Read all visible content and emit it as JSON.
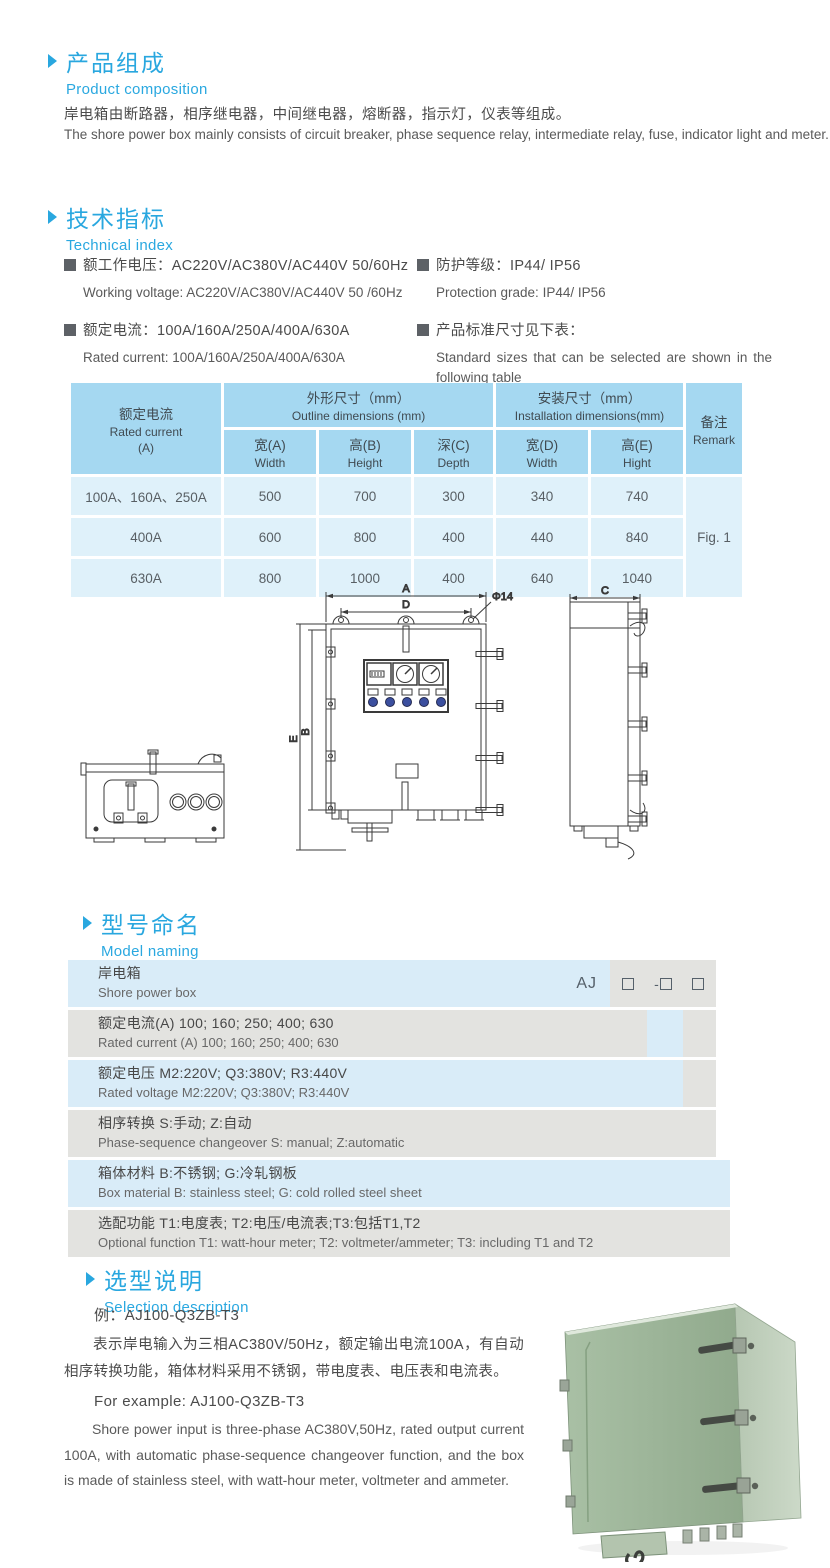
{
  "colors": {
    "accent_blue": "#29a7df",
    "table_header_bg": "#a5d8f1",
    "table_body_bg": "#dff1fa",
    "model_row_blue": "#d9ecf8",
    "model_row_gray": "#e3e3e0",
    "indicator_lamp_blue": "#3b4f9f",
    "photo_green_front": "#9db699",
    "photo_green_side": "#c9d8c5"
  },
  "s1": {
    "title_zh": "产品组成",
    "title_en": "Product  composition",
    "para_zh": "岸电箱由断路器，相序继电器，中间继电器，熔断器，指示灯，仪表等组成。",
    "para_en": "The shore power box mainly consists of circuit breaker, phase sequence relay, intermediate relay, fuse, indicator light and meter."
  },
  "s2": {
    "title_zh": "技术指标",
    "title_en": "Technical index",
    "items": [
      {
        "zh": "额工作电压：AC220V/AC380V/AC440V  50/60Hz",
        "en": "Working voltage: AC220V/AC380V/AC440V 50 /60Hz"
      },
      {
        "zh": "额定电流：100A/160A/250A/400A/630A",
        "en": "Rated current: 100A/160A/250A/400A/630A"
      },
      {
        "zh": "防护等级：IP44/ IP56",
        "en": "Protection grade: IP44/ IP56"
      },
      {
        "zh": "产品标准尺寸见下表：",
        "en": "Standard sizes that can be selected are shown in the following table"
      }
    ]
  },
  "dim_table": {
    "rated_zh": "额定电流",
    "rated_en": "Rated current",
    "rated_unit": "(A)",
    "outline_zh": "外形尺寸（mm）",
    "outline_en": "Outline dimensions (mm)",
    "install_zh": "安装尺寸（mm）",
    "install_en": "Installation dimensions(mm)",
    "remark_zh": "备注",
    "remark_en": "Remark",
    "sub": [
      {
        "zh": "宽(A)",
        "en": "Width"
      },
      {
        "zh": "高(B)",
        "en": "Height"
      },
      {
        "zh": "深(C)",
        "en": "Depth"
      },
      {
        "zh": "宽(D)",
        "en": "Width"
      },
      {
        "zh": "高(E)",
        "en": "Hight"
      }
    ],
    "rows": [
      {
        "current": "100A、160A、250A",
        "w": "500",
        "h": "700",
        "d": "300",
        "iw": "340",
        "ih": "740"
      },
      {
        "current": "400A",
        "w": "600",
        "h": "800",
        "d": "400",
        "iw": "440",
        "ih": "840"
      },
      {
        "current": "630A",
        "w": "800",
        "h": "1000",
        "d": "400",
        "iw": "640",
        "ih": "1040"
      }
    ],
    "remark_value": "Fig. 1"
  },
  "drawing": {
    "labels": {
      "a": "A",
      "d": "D",
      "phi": "Φ14",
      "e": "E",
      "b": "B",
      "c": "C"
    }
  },
  "s3": {
    "title_zh": "型号命名",
    "title_en": "Model naming",
    "prefix": "AJ",
    "dash": "-",
    "rows": [
      {
        "zh": "岸电箱",
        "en": "Shore power box"
      },
      {
        "zh": "额定电流(A)  100; 160; 250; 400; 630",
        "en": "Rated current (A) 100; 160; 250; 400; 630"
      },
      {
        "zh": "额定电压  M2:220V;  Q3:380V;  R3:440V",
        "en": "Rated voltage  M2:220V;  Q3:380V;  R3:440V"
      },
      {
        "zh": "相序转换  S:手动; Z:自动",
        "en": "Phase-sequence changeover  S: manual;  Z:automatic"
      },
      {
        "zh": "箱体材料   B:不锈钢;  G:冷轧钢板",
        "en": "Box material   B: stainless steel; G: cold rolled steel sheet"
      },
      {
        "zh": "选配功能   T1:电度表;  T2:电压/电流表;T3:包括T1,T2",
        "en": "Optional function  T1: watt-hour meter; T2: voltmeter/ammeter; T3: including T1 and T2"
      }
    ]
  },
  "s4": {
    "title_zh": "选型说明",
    "title_en": "Selection description",
    "example_zh": "例：AJ100-Q3ZB-T3",
    "para_zh": "表示岸电输入为三相AC380V/50Hz，额定输出电流100A，有自动相序转换功能，箱体材料采用不锈钢，带电度表、电压表和电流表。",
    "example_en": "For example: AJ100-Q3ZB-T3",
    "para_en": "Shore power input is three-phase AC380V,50Hz, rated output current 100A, with automatic phase-sequence changeover function, and the box is made of stainless steel, with watt-hour meter, voltmeter and ammeter."
  }
}
